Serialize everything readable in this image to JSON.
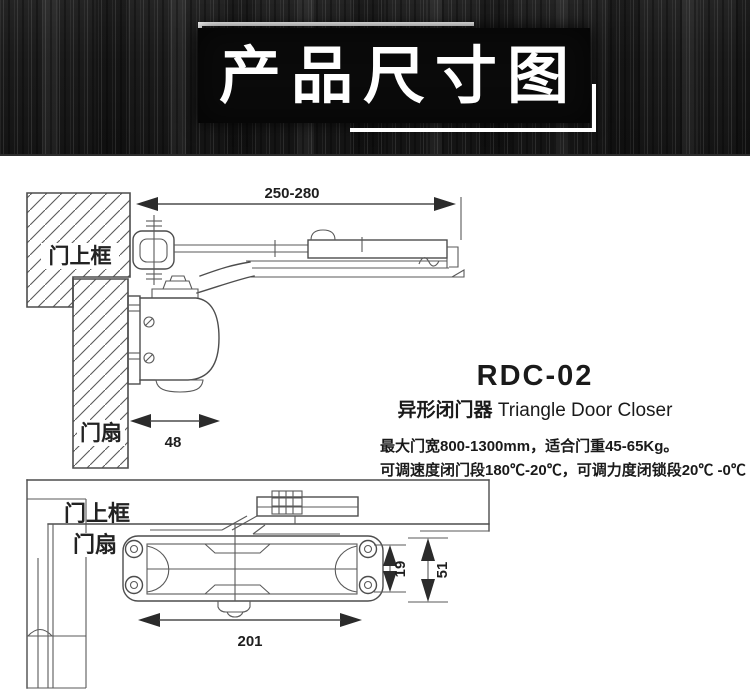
{
  "banner": {
    "title": "产品尺寸图"
  },
  "product": {
    "model": "RDC-02",
    "name_cn": "异形闭门器",
    "name_en": "Triangle Door Closer",
    "spec_line1": "最大门宽800-1300mm，适合门重45-65Kg。",
    "spec_line2": "可调速度闭门段180℃-20℃，可调力度闭锁段20℃ -0℃ 。"
  },
  "side_view": {
    "labels": {
      "door_top_frame": "门上框",
      "door_leaf": "门扇"
    },
    "dimensions": {
      "arm_length": "250-280",
      "body_depth": "48"
    }
  },
  "front_view": {
    "labels": {
      "door_top_frame": "门上框",
      "door_leaf": "门扇"
    },
    "dimensions": {
      "body_length": "201",
      "hole_spacing": "19",
      "body_height": "51"
    }
  },
  "colors": {
    "line": "#4d4d4d",
    "banner_bg": "#1a1a1a",
    "title_box": "#0a0a0a",
    "title_text": "#ffffff",
    "arrow": "#2b2b2b"
  }
}
